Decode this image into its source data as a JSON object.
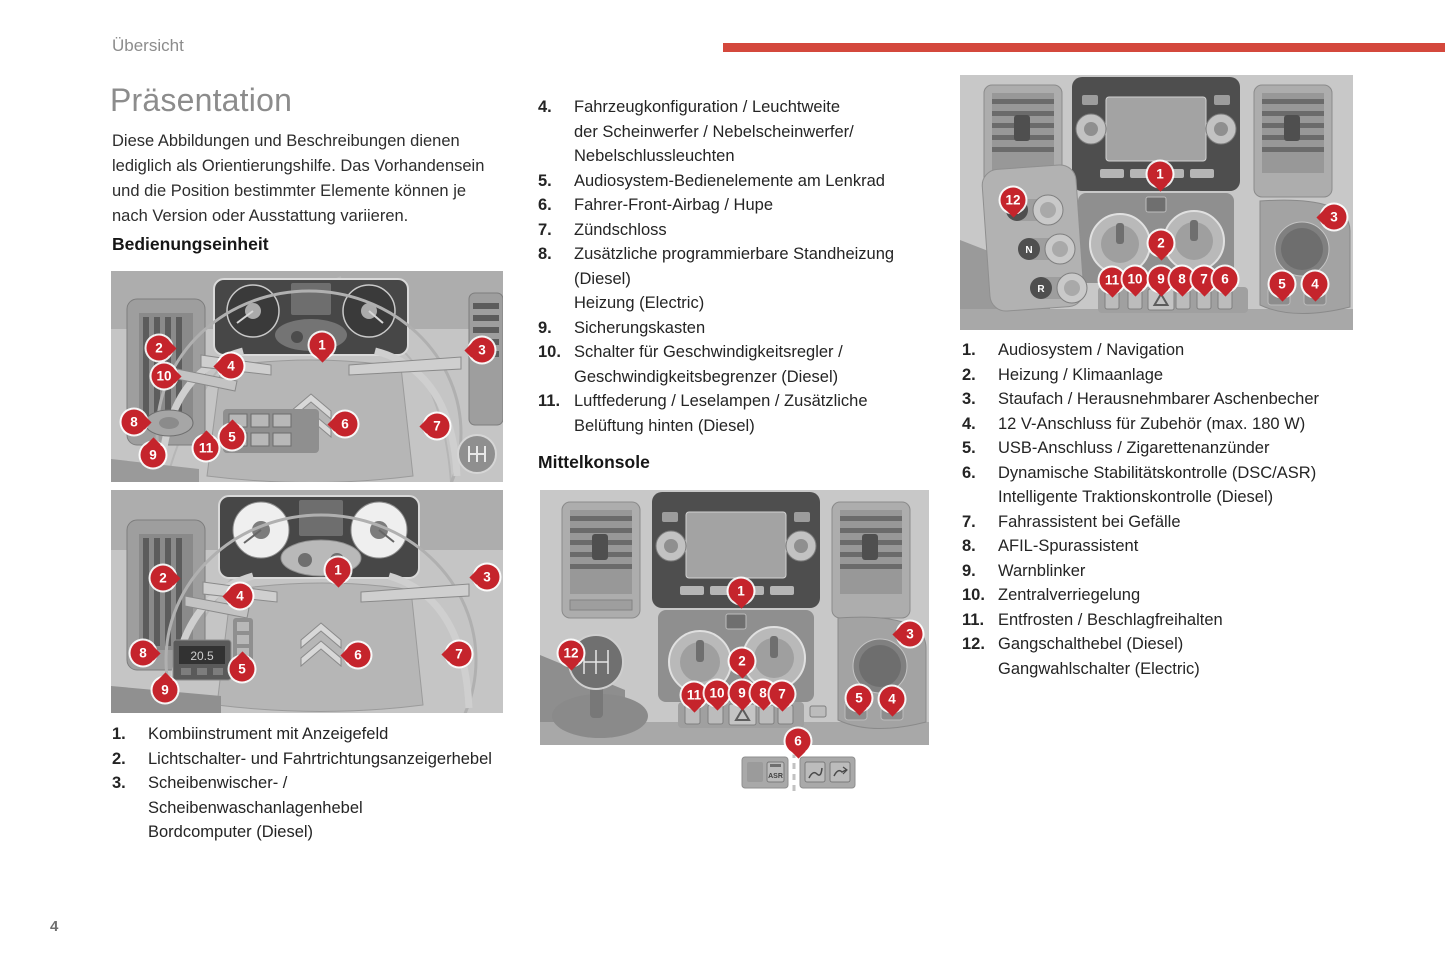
{
  "page": {
    "header": "Übersicht",
    "page_number": "4",
    "colors": {
      "accent_red": "#d4483c",
      "marker_red": "#c5242c"
    }
  },
  "left": {
    "title": "Präsentation",
    "intro": "Diese Abbildungen und Beschreibungen dienen lediglich als Orientierungshilfe. Das Vorhandensein und die Position bestimmter Elemente können je nach Version oder Ausstattung variieren.",
    "section_heading": "Bedienungseinheit",
    "list": [
      {
        "num": "1.",
        "lines": [
          "Kombiinstrument mit Anzeigefeld"
        ]
      },
      {
        "num": "2.",
        "lines": [
          "Lichtschalter- und Fahrtrichtungsanzeigerhebel"
        ]
      },
      {
        "num": "3.",
        "lines": [
          "Scheibenwischer- /",
          "Scheibenwaschanlagenhebel",
          "Bordcomputer (Diesel)"
        ]
      }
    ]
  },
  "middle": {
    "section_heading": "Mittelkonsole",
    "list": [
      {
        "num": "4.",
        "lines": [
          "Fahrzeugkonfiguration / Leuchtweite",
          "der Scheinwerfer / Nebelscheinwerfer/",
          "Nebelschlussleuchten"
        ]
      },
      {
        "num": "5.",
        "lines": [
          "Audiosystem-Bedienelemente am Lenkrad"
        ]
      },
      {
        "num": "6.",
        "lines": [
          "Fahrer-Front-Airbag / Hupe"
        ]
      },
      {
        "num": "7.",
        "lines": [
          "Zündschloss"
        ]
      },
      {
        "num": "8.",
        "lines": [
          "Zusätzliche programmierbare Standheizung",
          "(Diesel)",
          "Heizung (Electric)"
        ]
      },
      {
        "num": "9.",
        "lines": [
          "Sicherungskasten"
        ]
      },
      {
        "num": "10.",
        "lines": [
          "Schalter für Geschwindigkeitsregler /",
          "Geschwindigkeitsbegrenzer (Diesel)"
        ]
      },
      {
        "num": "11.",
        "lines": [
          "Luftfederung / Leselampen / Zusätzliche",
          "Belüftung hinten (Diesel)"
        ]
      }
    ]
  },
  "right": {
    "list": [
      {
        "num": "1.",
        "lines": [
          "Audiosystem / Navigation"
        ]
      },
      {
        "num": "2.",
        "lines": [
          "Heizung / Klimaanlage"
        ]
      },
      {
        "num": "3.",
        "lines": [
          "Staufach / Herausnehmbarer Aschenbecher"
        ]
      },
      {
        "num": "4.",
        "lines": [
          "12 V-Anschluss für Zubehör (max. 180 W)"
        ]
      },
      {
        "num": "5.",
        "lines": [
          "USB-Anschluss / Zigarettenanzünder"
        ]
      },
      {
        "num": "6.",
        "lines": [
          "Dynamische Stabilitätskontrolle (DSC/ASR)",
          "Intelligente Traktionskontrolle (Diesel)"
        ]
      },
      {
        "num": "7.",
        "lines": [
          "Fahrassistent bei Gefälle"
        ]
      },
      {
        "num": "8.",
        "lines": [
          "AFIL-Spurassistent"
        ]
      },
      {
        "num": "9.",
        "lines": [
          "Warnblinker"
        ]
      },
      {
        "num": "10.",
        "lines": [
          "Zentralverriegelung"
        ]
      },
      {
        "num": "11.",
        "lines": [
          "Entfrosten / Beschlagfreihalten"
        ]
      },
      {
        "num": "12.",
        "lines": [
          "Gangschalthebel (Diesel)",
          "Gangwahlschalter (Electric)"
        ]
      }
    ]
  },
  "figures": {
    "climate_display_value": "20.5",
    "asr_label": "ASR",
    "gear_selector_labels": [
      "D",
      "N",
      "R"
    ],
    "markers": {
      "fig1": [
        {
          "n": "1",
          "x": 211,
          "y": 74,
          "dir": "down"
        },
        {
          "n": "2",
          "x": 48,
          "y": 77,
          "dir": "right"
        },
        {
          "n": "3",
          "x": 371,
          "y": 79,
          "dir": "left"
        },
        {
          "n": "4",
          "x": 120,
          "y": 95,
          "dir": "left"
        },
        {
          "n": "10",
          "x": 53,
          "y": 105,
          "dir": "right"
        },
        {
          "n": "8",
          "x": 23,
          "y": 151,
          "dir": "right"
        },
        {
          "n": "9",
          "x": 42,
          "y": 184,
          "dir": "up"
        },
        {
          "n": "11",
          "x": 95,
          "y": 177,
          "dir": "up"
        },
        {
          "n": "5",
          "x": 121,
          "y": 166,
          "dir": "up"
        },
        {
          "n": "6",
          "x": 234,
          "y": 153,
          "dir": "left"
        },
        {
          "n": "7",
          "x": 326,
          "y": 155,
          "dir": "left"
        }
      ],
      "fig2": [
        {
          "n": "1",
          "x": 227,
          "y": 80,
          "dir": "down"
        },
        {
          "n": "2",
          "x": 52,
          "y": 88,
          "dir": "right"
        },
        {
          "n": "3",
          "x": 376,
          "y": 87,
          "dir": "left"
        },
        {
          "n": "4",
          "x": 129,
          "y": 106,
          "dir": "left"
        },
        {
          "n": "8",
          "x": 32,
          "y": 163,
          "dir": "right"
        },
        {
          "n": "5",
          "x": 131,
          "y": 179,
          "dir": "up"
        },
        {
          "n": "9",
          "x": 54,
          "y": 200,
          "dir": "up"
        },
        {
          "n": "6",
          "x": 247,
          "y": 165,
          "dir": "left"
        },
        {
          "n": "7",
          "x": 348,
          "y": 164,
          "dir": "left"
        }
      ],
      "fig3": [
        {
          "n": "1",
          "x": 201,
          "y": 101,
          "dir": "down"
        },
        {
          "n": "2",
          "x": 202,
          "y": 171,
          "dir": "down"
        },
        {
          "n": "3",
          "x": 370,
          "y": 144,
          "dir": "left"
        },
        {
          "n": "12",
          "x": 31,
          "y": 163,
          "dir": "down"
        },
        {
          "n": "11",
          "x": 154,
          "y": 205,
          "dir": "down"
        },
        {
          "n": "10",
          "x": 177,
          "y": 203,
          "dir": "down"
        },
        {
          "n": "9",
          "x": 202,
          "y": 203,
          "dir": "down"
        },
        {
          "n": "8",
          "x": 223,
          "y": 203,
          "dir": "down"
        },
        {
          "n": "7",
          "x": 242,
          "y": 204,
          "dir": "down"
        },
        {
          "n": "5",
          "x": 319,
          "y": 208,
          "dir": "down"
        },
        {
          "n": "4",
          "x": 352,
          "y": 209,
          "dir": "down"
        },
        {
          "n": "6",
          "x": 258,
          "y": 251,
          "dir": "down"
        }
      ],
      "fig4": [
        {
          "n": "1",
          "x": 200,
          "y": 99,
          "dir": "down"
        },
        {
          "n": "2",
          "x": 201,
          "y": 168,
          "dir": "down"
        },
        {
          "n": "3",
          "x": 374,
          "y": 142,
          "dir": "left"
        },
        {
          "n": "12",
          "x": 53,
          "y": 125,
          "dir": "down"
        },
        {
          "n": "11",
          "x": 152,
          "y": 205,
          "dir": "down"
        },
        {
          "n": "10",
          "x": 175,
          "y": 204,
          "dir": "down"
        },
        {
          "n": "9",
          "x": 201,
          "y": 204,
          "dir": "down"
        },
        {
          "n": "8",
          "x": 222,
          "y": 204,
          "dir": "down"
        },
        {
          "n": "7",
          "x": 244,
          "y": 204,
          "dir": "down"
        },
        {
          "n": "6",
          "x": 265,
          "y": 204,
          "dir": "down"
        },
        {
          "n": "5",
          "x": 322,
          "y": 209,
          "dir": "down"
        },
        {
          "n": "4",
          "x": 355,
          "y": 209,
          "dir": "down"
        }
      ]
    }
  }
}
